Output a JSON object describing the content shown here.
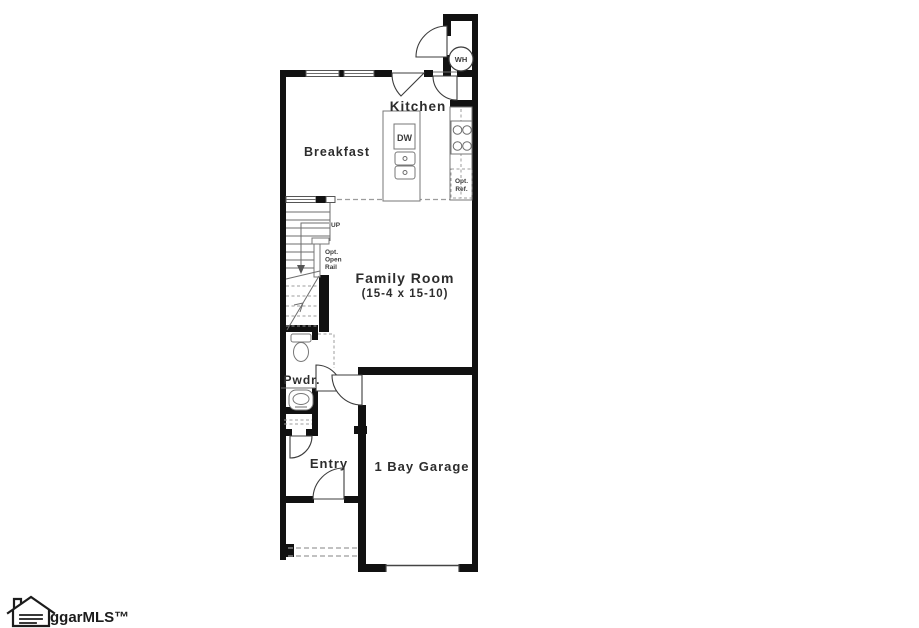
{
  "floor_plan": {
    "labels": {
      "kitchen": "Kitchen",
      "breakfast": "Breakfast",
      "family_room_name": "Family Room",
      "family_room_dims": "(15-4 x 15-10)",
      "powder": "Pwdr.",
      "entry": "Entry",
      "garage": "1 Bay Garage",
      "water_heater": "WH",
      "dishwasher": "DW",
      "up": "UP",
      "opt_ref_line1": "Opt.",
      "opt_ref_line2": "Ref.",
      "opt_rail_line1": "Opt.",
      "opt_rail_line2": "Open",
      "opt_rail_line3": "Rail"
    },
    "colors": {
      "wall": "#111111",
      "text": "#2d2d2d",
      "thin_line": "#6d6d6d",
      "dashed_line": "#9c9c9c",
      "background": "#ffffff"
    }
  },
  "watermark": {
    "logo_text": "ggarMLS™"
  }
}
